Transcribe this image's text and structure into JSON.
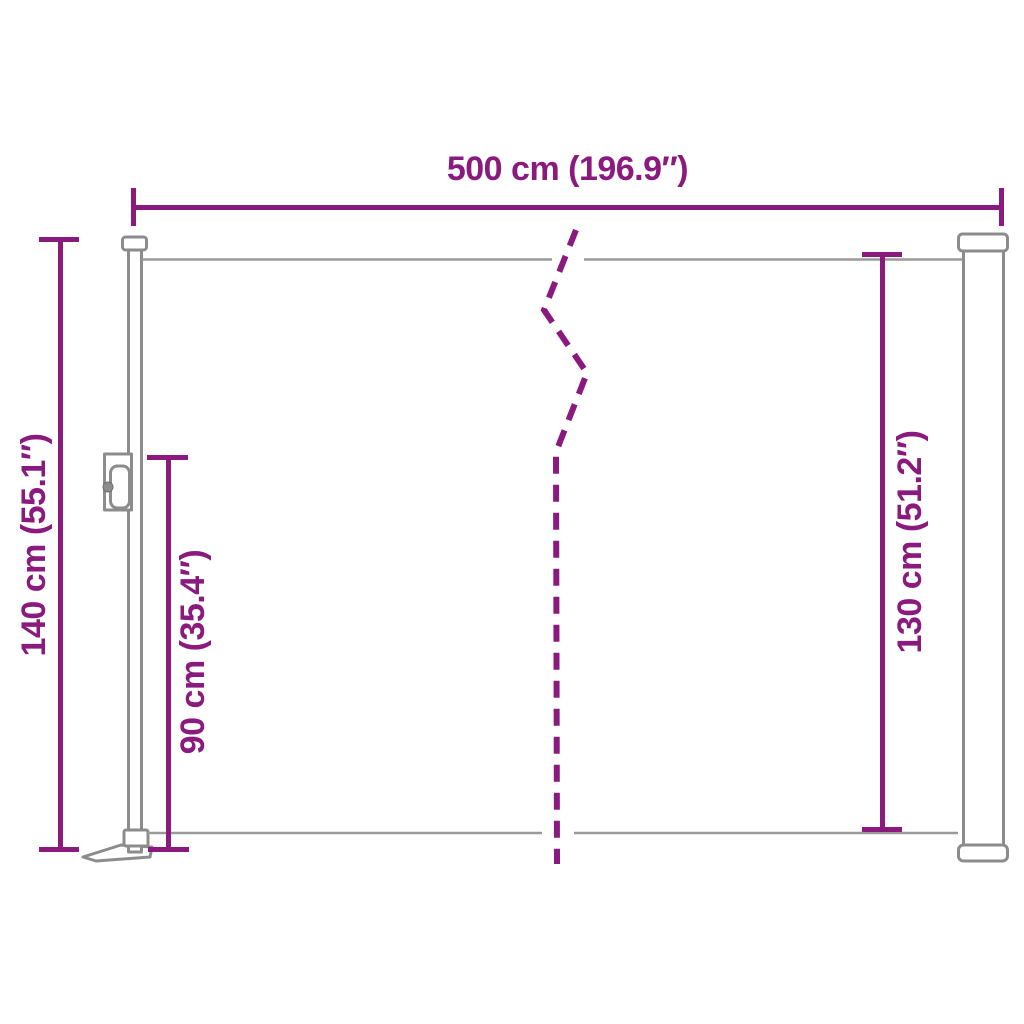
{
  "diagram": {
    "type": "product-dimension-diagram",
    "subject": "retractable side awning",
    "accent_color": "#8a1a7e",
    "outline_color": "#8c8c8c",
    "background_color": "#ffffff",
    "measurements": {
      "top_width": "500 cm (196.9″)",
      "left_total_height": "140 cm (55.1″)",
      "left_inner_height": "90 cm (35.4″)",
      "right_fabric_height": "130 cm (51.2″)"
    }
  }
}
